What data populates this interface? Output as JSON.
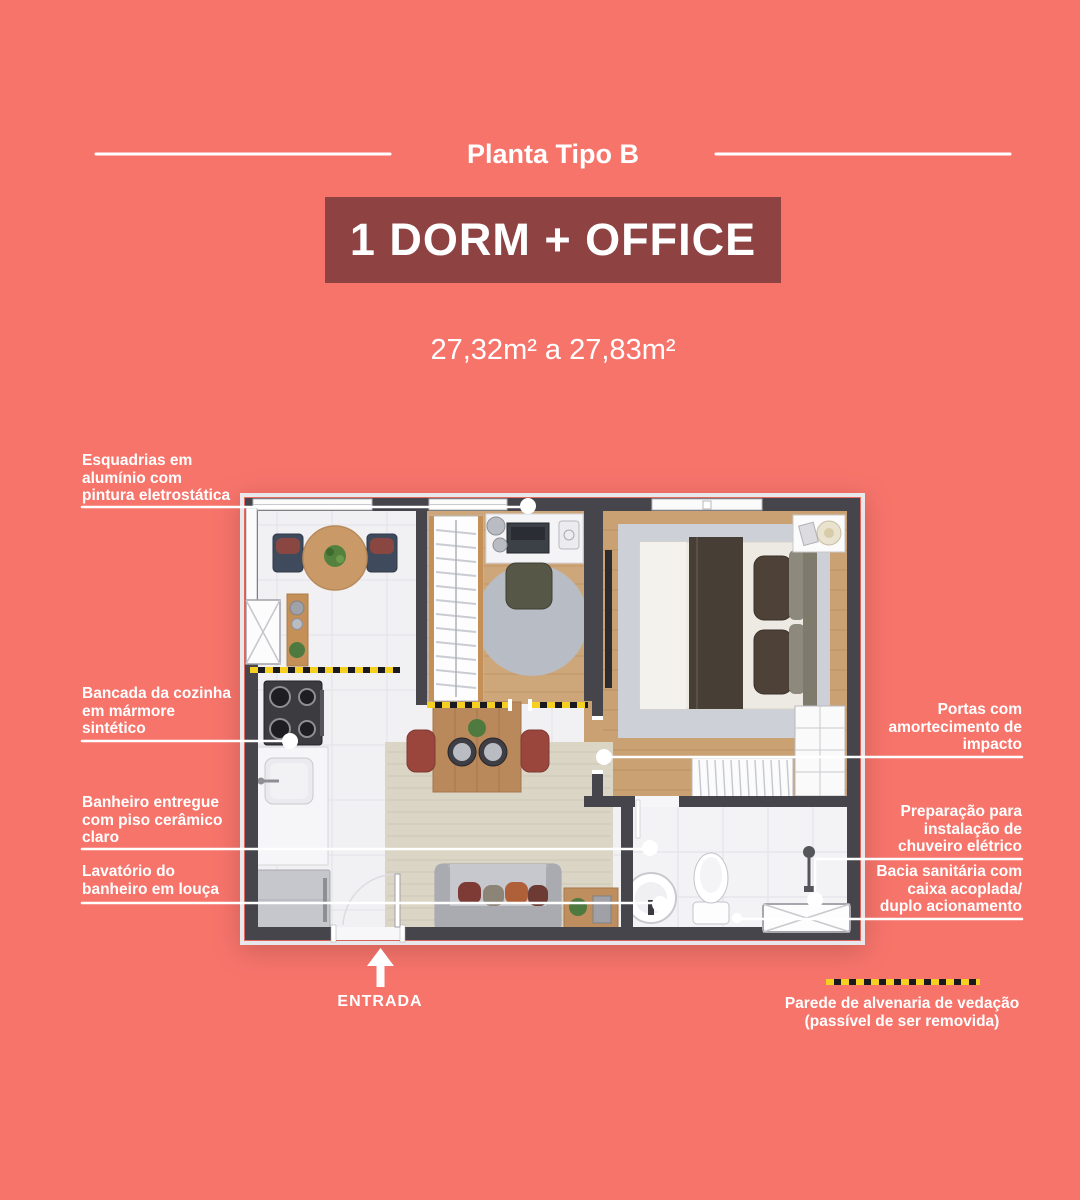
{
  "header": {
    "title": "Planta Tipo B"
  },
  "badge": {
    "title": "1 DORM + OFFICE"
  },
  "area": {
    "range": "27,32m² a 27,83m²"
  },
  "callouts": {
    "left": [
      {
        "text": "Esquadrias em\nalumínio com\npintura eletrostática"
      },
      {
        "text": "Bancada da cozinha\nem mármore\nsintético"
      },
      {
        "text": "Banheiro entregue\ncom piso cerâmico\nclaro"
      },
      {
        "text": "Lavatório do\nbanheiro em louça"
      }
    ],
    "right": [
      {
        "text": "Portas com\namortecimento de\nimpacto"
      },
      {
        "text": "Preparação para\ninstalação de\nchuveiro elétrico"
      },
      {
        "text": "Bacia sanitária com\ncaixa acoplada/\nduplo acionamento"
      }
    ]
  },
  "entrance": {
    "label": "ENTRADA",
    "arrow_icon": "up-arrow"
  },
  "legend": {
    "text": "Parede de alvenaria de vedação\n(passível de ser removida)",
    "line_style": "yellow-black-dashed"
  },
  "colors": {
    "background": "#F7746B",
    "badge_bg": "#8E4242",
    "text": "#FFFFFF",
    "walls": "#45454B",
    "removable_wall_tape": "#F5D021",
    "wood_floor": "#C9A173"
  }
}
